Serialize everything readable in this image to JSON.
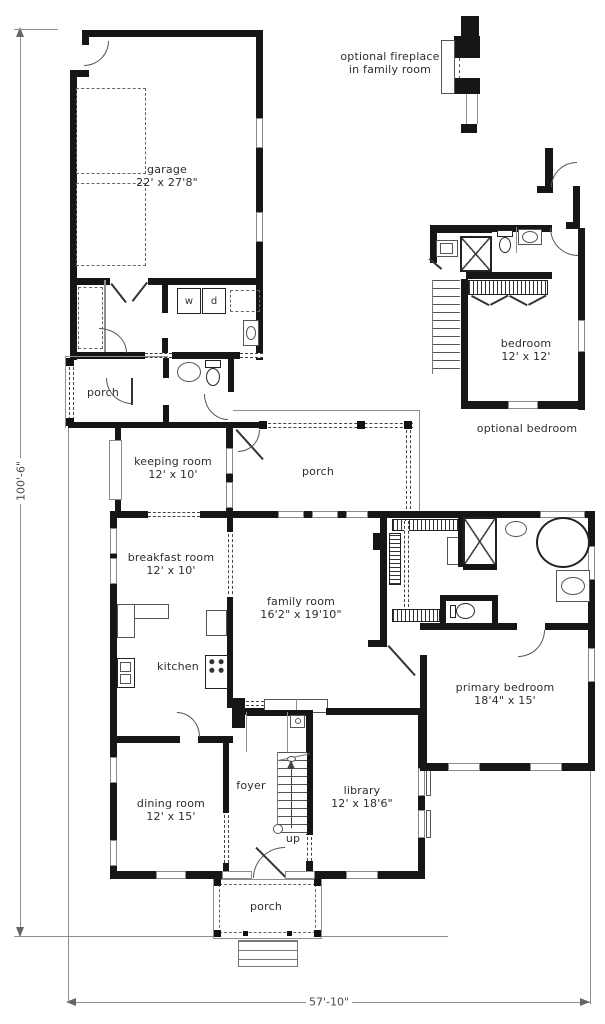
{
  "sheet": {
    "dimension_height": "100'-6\"",
    "dimension_width": "57'-10\"",
    "fireplace_note_line1": "optional fireplace",
    "fireplace_note_line2": "in family room",
    "optional_bedroom_note": "optional bedroom",
    "up_label": "up",
    "washer_label": "w",
    "dryer_label": "d"
  },
  "rooms": {
    "garage": {
      "name": "garage",
      "size": "22' x 27'8\""
    },
    "porch_left": {
      "name": "porch"
    },
    "keeping_room": {
      "name": "keeping room",
      "size": "12' x 10'"
    },
    "porch_center": {
      "name": "porch"
    },
    "breakfast_room": {
      "name": "breakfast room",
      "size": "12' x 10'"
    },
    "family_room": {
      "name": "family room",
      "size": "16'2\" x 19'10\""
    },
    "kitchen": {
      "name": "kitchen"
    },
    "primary_bedroom": {
      "name": "primary bedroom",
      "size": "18'4\" x 15'"
    },
    "dining_room": {
      "name": "dining room",
      "size": "12' x 15'"
    },
    "foyer": {
      "name": "foyer"
    },
    "library": {
      "name": "library",
      "size": "12' x 18'6\""
    },
    "porch_bottom": {
      "name": "porch"
    },
    "optional_bedroom": {
      "name": "bedroom",
      "size": "12' x 12'"
    }
  }
}
